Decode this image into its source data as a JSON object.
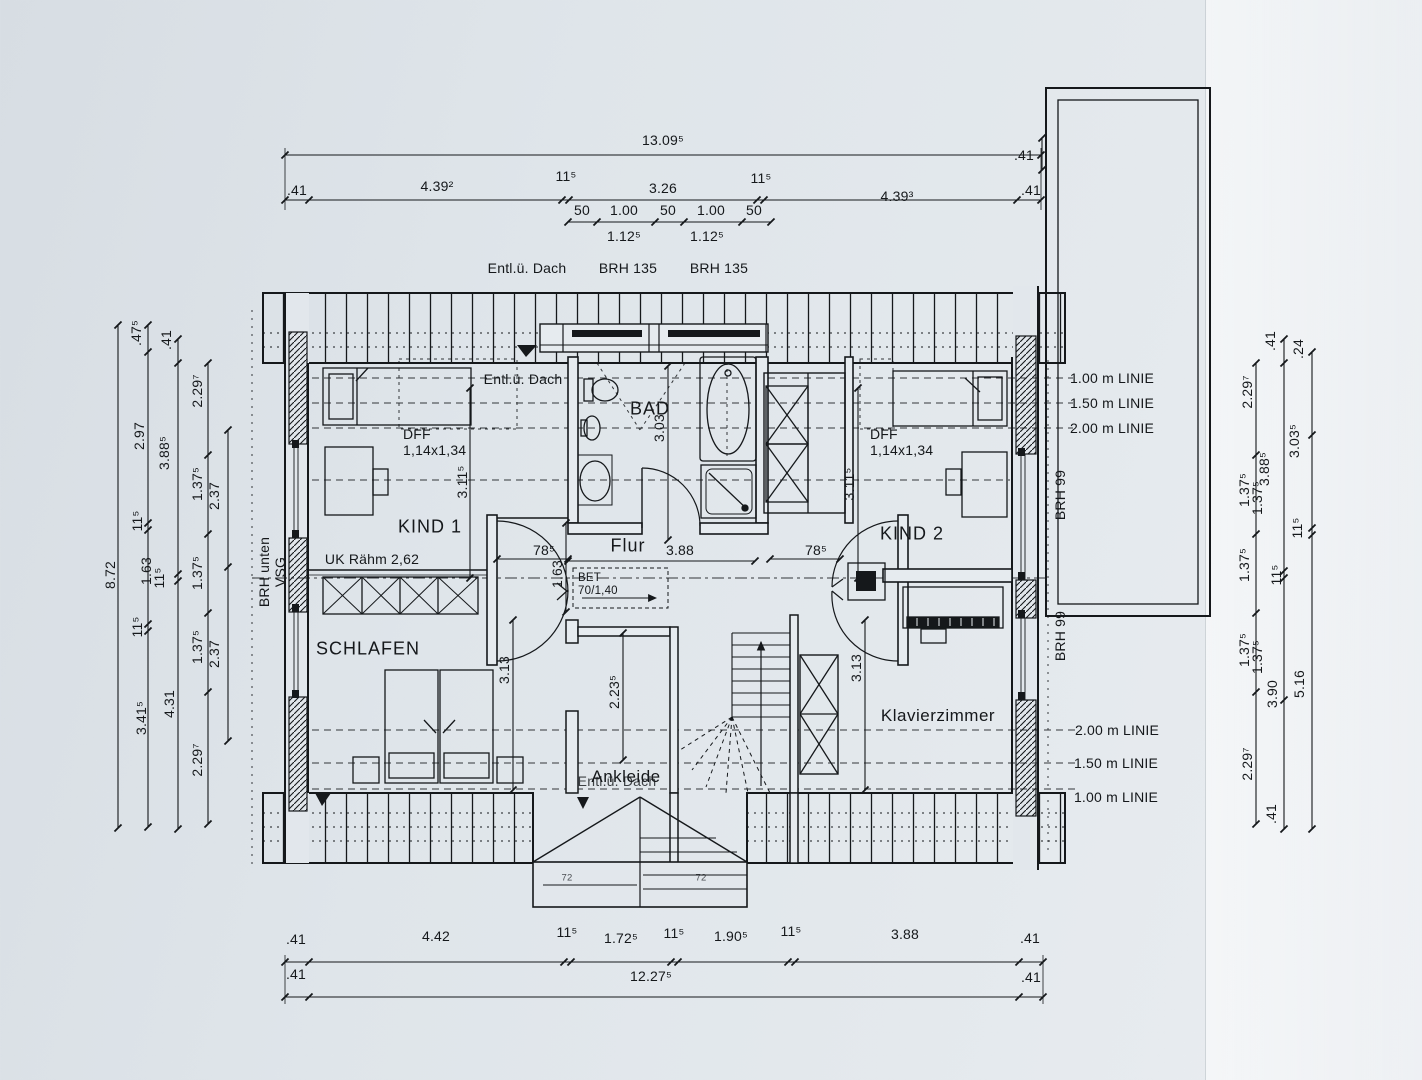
{
  "colors": {
    "paper": "#e2e7ec",
    "ink": "#15181b"
  },
  "rooms": {
    "kind1": "KIND 1",
    "kind2": "KIND 2",
    "bad": "BAD",
    "flur": "Flur",
    "schlafen": "SCHLAFEN",
    "klavierzimmer": "Klavierzimmer",
    "ankleide": "Ankleide"
  },
  "dims": {
    "top_overall": "13.09⁵",
    "top_chain": [
      ".41",
      "4.39²",
      "11⁵",
      "3.26",
      "11⁵",
      "4.39³",
      ".41"
    ],
    "win_chain": [
      "50",
      "1.00",
      "50",
      "1.00",
      "50"
    ],
    "win_chain2": [
      "1.12⁵",
      "1.12⁵"
    ],
    "bottom_chain": [
      ".41",
      "4.42",
      "11⁵",
      "1.72⁵",
      "11⁵",
      "1.90⁵",
      "11⁵",
      "3.88",
      ".41"
    ],
    "bottom_overall": [
      ".41",
      "12.27⁵",
      ".41"
    ],
    "annex": ".41",
    "left": [
      "8.72",
      ".47⁵",
      ".41",
      "2.29⁷",
      "2.97",
      "3.88⁵",
      "1.37⁵",
      "2.37",
      "11⁵",
      "1.63",
      "11⁵",
      "1.37⁵",
      "11⁵",
      "1.37⁵",
      "2.37",
      "3.41⁵",
      "4.31",
      "2.29⁷"
    ],
    "right": [
      ".41",
      ".24",
      "2.29⁷",
      "3.03⁵",
      "3.88⁵",
      "1.37⁵",
      "1.37⁵",
      "11⁵",
      "1.37⁵",
      "11⁵",
      "1.37⁵",
      "1.37⁵",
      "5.16",
      "3.90",
      "2.29⁷",
      ".41"
    ],
    "inner": {
      "kind1_w": "3.11⁵",
      "kind2_w": "3.11⁵",
      "bad_d": "3.03",
      "flur_w": "3.88",
      "door_l": "78⁵",
      "door_r": "78⁵",
      "flur_n": "1.63",
      "ankleide_d": "2.23⁵",
      "schlafen_d": "3.13",
      "klavier_d": "3.13"
    },
    "dormer": [
      "72",
      "72"
    ]
  },
  "notes": {
    "entl_dach_top": "Entl.ü. Dach",
    "brh135_a": "BRH 135",
    "brh135_b": "BRH 135",
    "entl_dach_kind1": "Entl.ü. Dach",
    "entl_dach_ankleide": "Entl.ü. Dach",
    "dff_l": "DFF\n1,14x1,34",
    "dff_r": "DFF\n1,14x1,34",
    "uk_rahm": "UK Rähm 2,62",
    "brh_vsg": "BRH unten\nVSG",
    "bet": "BET\n70/1,40",
    "linie_top": [
      "1.00 m LINIE",
      "1.50 m LINIE",
      "2.00 m LINIE"
    ],
    "linie_bottom": [
      "2.00 m LINIE",
      "1.50 m LINIE",
      "1.00 m LINIE"
    ],
    "brh99_a": "BRH 99",
    "brh99_b": "BRH 99"
  }
}
